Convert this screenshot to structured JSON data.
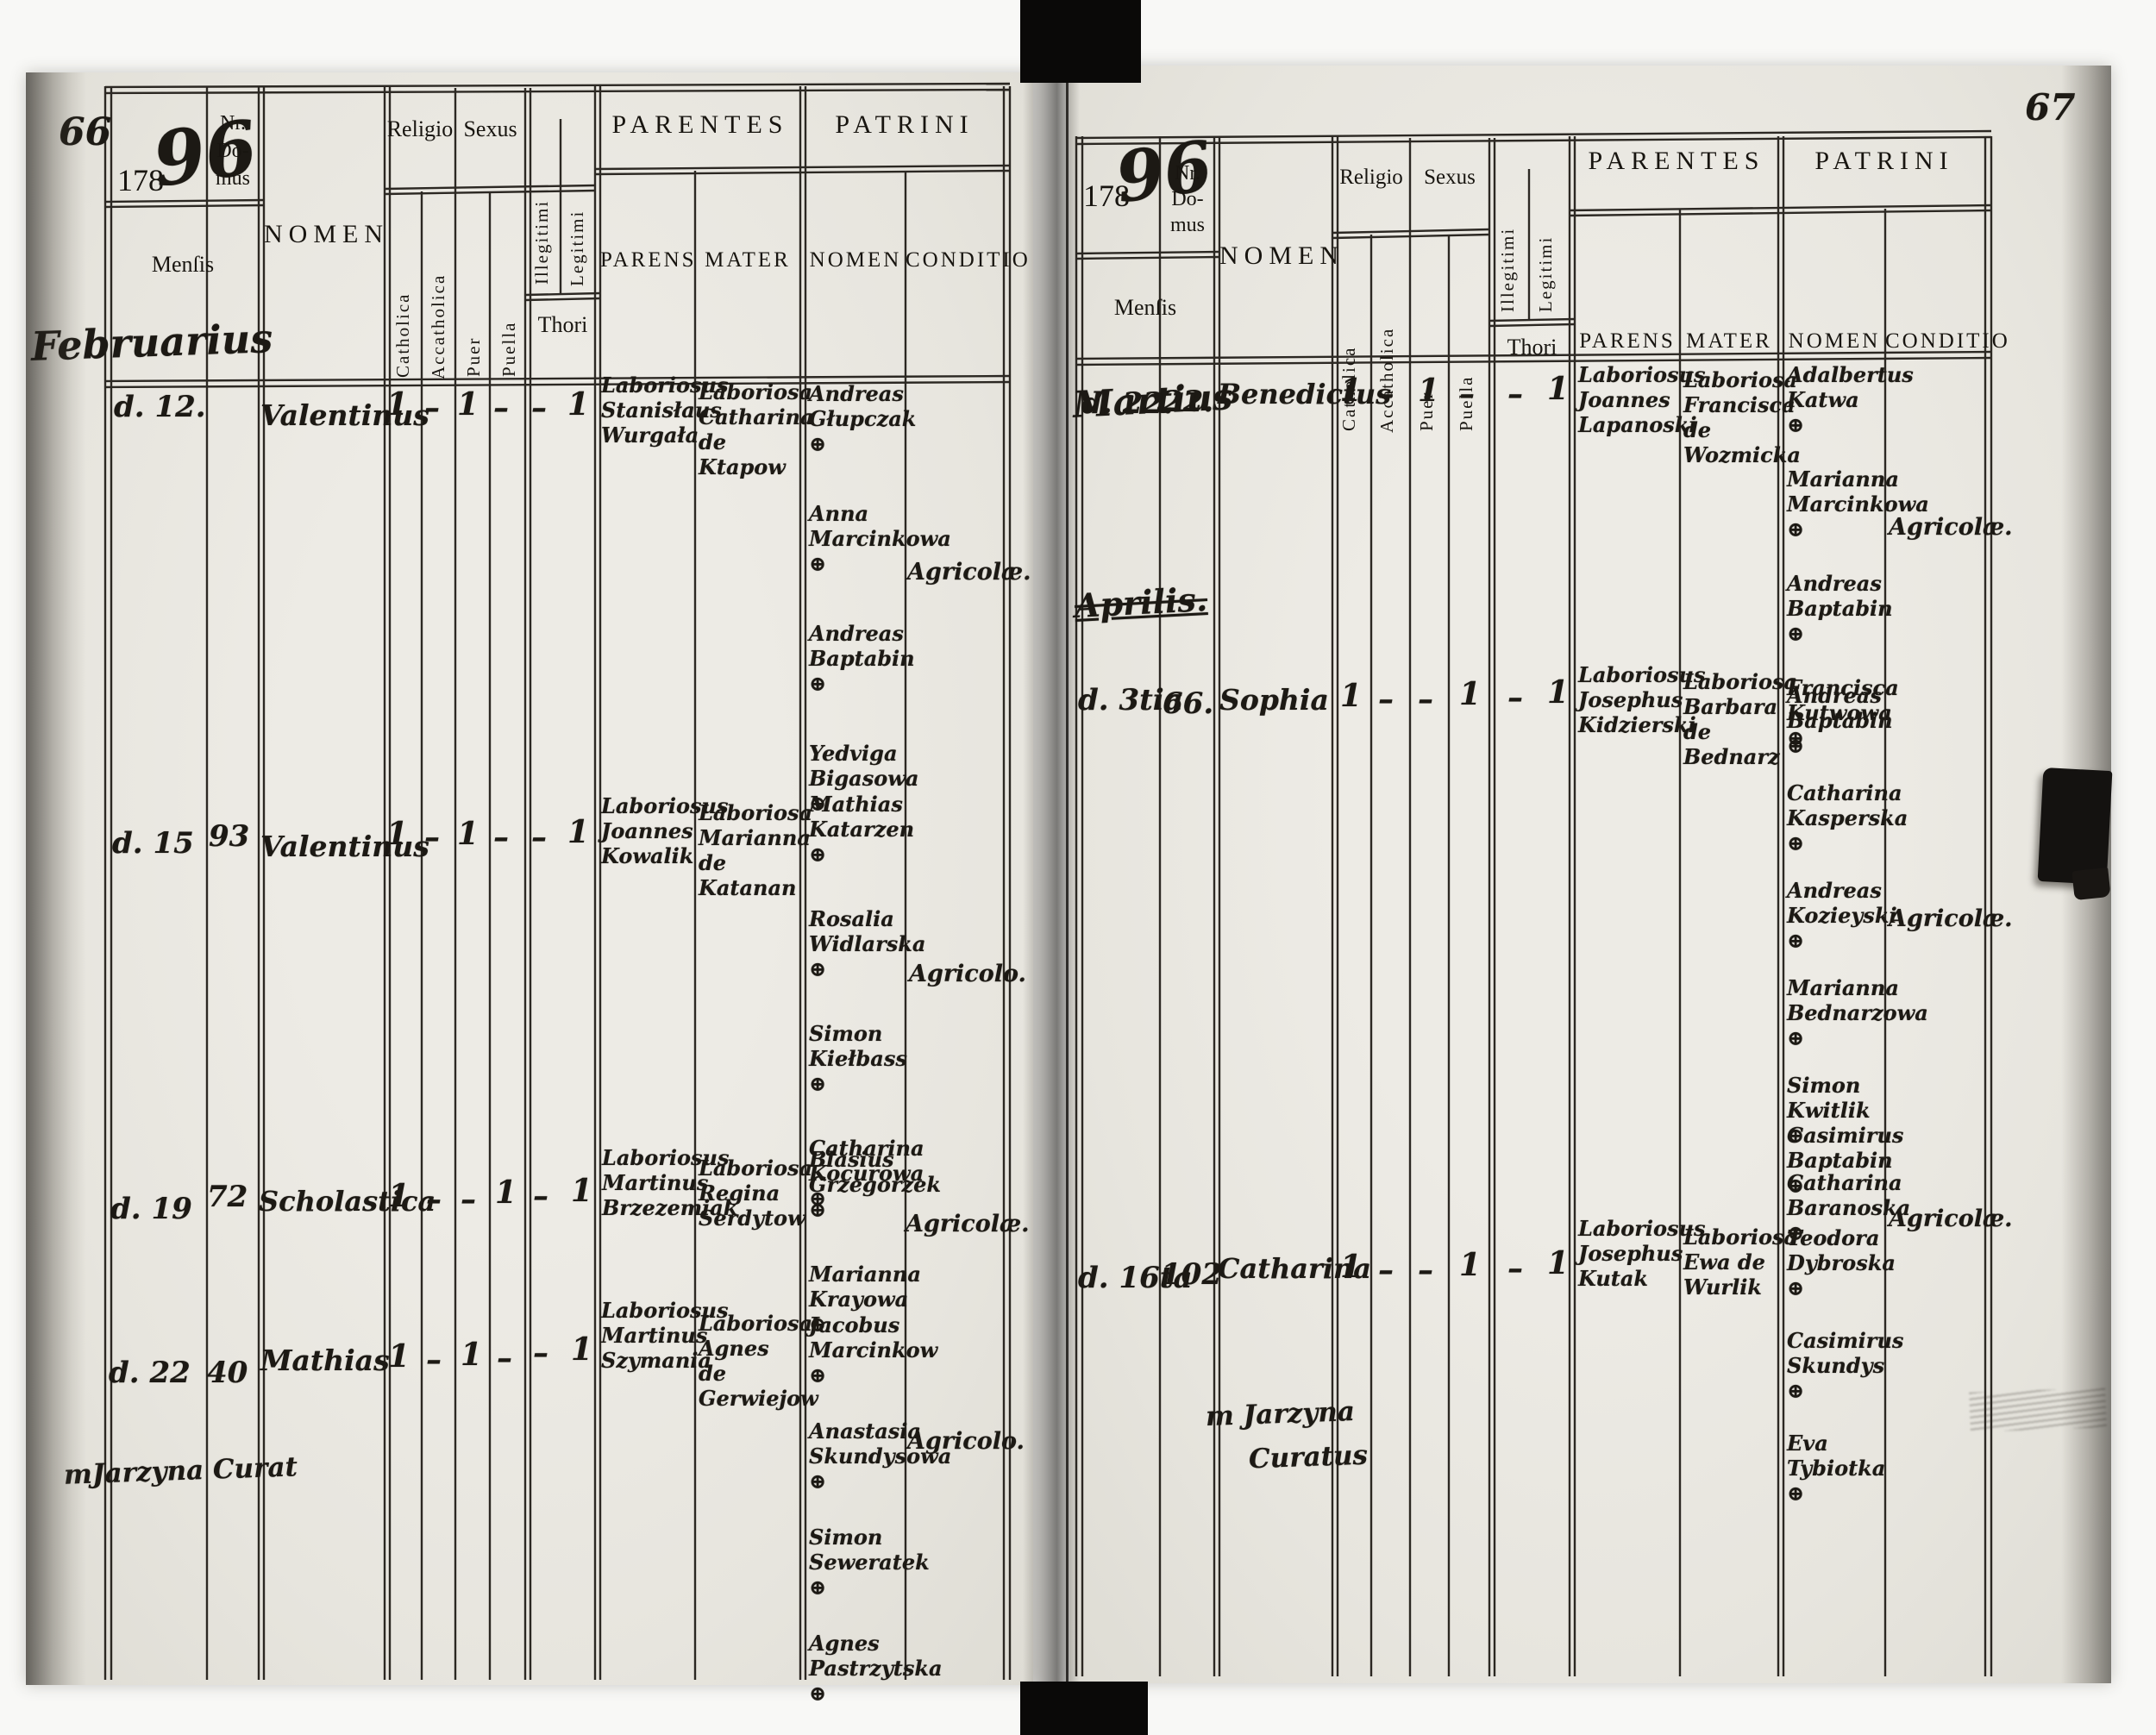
{
  "header": {
    "year_printed": "178",
    "year_script": "96",
    "nr_domus": [
      "Nr.",
      "Do-",
      "mus"
    ],
    "mensis": "Menſis",
    "nomen": "NOMEN",
    "religio": "Religio",
    "sexus": "Sexus",
    "catholica": "Catholica",
    "accatholica": "Accatholica",
    "puer": "Puer",
    "puella": "Puella",
    "illegitimi": "Illegitimi",
    "legitimi": "Legitimi",
    "thori": "Thori",
    "parentes": "PARENTES",
    "parens": "PARENS",
    "mater": "MATER",
    "patrini": "PATRINI",
    "patrini_nomen": "NOMEN",
    "conditio": "CONDITIO"
  },
  "left_page": {
    "folio": "66",
    "month": "Februarius",
    "rows": [
      {
        "die": "d. 12.",
        "domus": "",
        "nomen": "Valentinus",
        "marks": {
          "catholica": "1",
          "accatholica": "–",
          "puer": "1",
          "puella": "–",
          "illegitimi": "–",
          "legitimi": "1"
        },
        "parens": "Laboriosus Stanisłaus Wurgała",
        "mater": "Laboriosa Catharina de Ktapow",
        "patrini": [
          "Andreas Głupczak ⊕",
          "Anna Marcinkowa ⊕",
          "Andreas Baptabin ⊕",
          "Yedviga Bigasowa ⊕"
        ],
        "conditio": "Agricolæ."
      },
      {
        "die": "d. 15",
        "domus": "93",
        "nomen": "Valentinus",
        "marks": {
          "catholica": "1",
          "accatholica": "–",
          "puer": "1",
          "puella": "–",
          "illegitimi": "–",
          "legitimi": "1"
        },
        "parens": "Laboriosus Joannes Kowalik",
        "mater": "Laboriosa Marianna de Katanan",
        "patrini": [
          "Mathias Katarzen ⊕",
          "Rosalia Widlarska ⊕",
          "Simon Kiełbass ⊕",
          "Catharina Kocurowa ⊕"
        ],
        "conditio": "Agricolo."
      },
      {
        "die": "d. 19",
        "domus": "72",
        "nomen": "Scholastica",
        "marks": {
          "catholica": "1",
          "accatholica": "–",
          "puer": "–",
          "puella": "1",
          "illegitimi": "–",
          "legitimi": "1"
        },
        "parens": "Laboriosus Martinus Brzezemiak",
        "mater": "Laboriosa Regina Serdytow",
        "patrini": [
          "Blasius Grzegorzek ⊕",
          "Marianna Krayowa ⊕"
        ],
        "conditio": "Agricolæ."
      },
      {
        "die": "d. 22",
        "domus": "40",
        "nomen": "Mathias",
        "marks": {
          "catholica": "1",
          "accatholica": "–",
          "puer": "1",
          "puella": "–",
          "illegitimi": "–",
          "legitimi": "1"
        },
        "parens": "Laboriosus Martinus Szymania",
        "mater": "Laboriosa Agnes de Gerwiejow",
        "patrini": [
          "Jacobus Marcinkow ⊕",
          "Anastasia Skundysowa ⊕",
          "Simon Seweratek ⊕",
          "Agnes Pastrzytska ⊕"
        ],
        "conditio": "Agricolo."
      }
    ],
    "signature": "mJarzyna   Curat"
  },
  "right_page": {
    "folio": "67",
    "month": "Martius",
    "section_month": "Aprilis.",
    "rows": [
      {
        "die": "d. 22.",
        "domus": "22.",
        "nomen": "Benedictus",
        "marks": {
          "catholica": "1",
          "accatholica": "–",
          "puer": "1",
          "puella": "–",
          "illegitimi": "–",
          "legitimi": "1"
        },
        "parens": "Laboriosus Joannes Lapanoski",
        "mater": "Laboriosa Francisca de Wozmicka",
        "patrini": [
          "Adalbertus Katwa ⊕",
          "Marianna Marcinkowa ⊕",
          "Andreas Baptabin ⊕",
          "Francisca Kutwowa ⊕"
        ],
        "conditio": "Agricolæ."
      },
      {
        "die": "d. 3tia",
        "domus": "66.",
        "nomen": "Sophia",
        "marks": {
          "catholica": "1",
          "accatholica": "–",
          "puer": "–",
          "puella": "1",
          "illegitimi": "–",
          "legitimi": "1"
        },
        "parens": "Laboriosus Josephus Kidzierski",
        "mater": "Laboriosa Barbara de Bednarz",
        "patrini": [
          "Andreas Baptabin ⊕",
          "Catharina Kasperska ⊕",
          "Andreas Kozieyski ⊕",
          "Marianna Bednarzowa ⊕",
          "Simon Kwitlik ⊕",
          "Catharina Baranoska ⊕"
        ],
        "conditio": "Agricolæ."
      },
      {
        "die": "d. 16ta",
        "domus": "102",
        "nomen": "Catharina",
        "marks": {
          "catholica": "1",
          "accatholica": "–",
          "puer": "–",
          "puella": "1",
          "illegitimi": "–",
          "legitimi": "1"
        },
        "parens": "Laboriosus Josephus Kutak",
        "mater": "Laboriosa Ewa de Wurlik",
        "patrini": [
          "Casimirus Baptabin ⊕",
          "Teodora Dybroska ⊕",
          "Casimirus Skundys ⊕",
          "Eva Tybiotka ⊕"
        ],
        "conditio": "Agricolæ."
      }
    ],
    "signature": [
      "m Jarzyna",
      "Curatus"
    ]
  }
}
